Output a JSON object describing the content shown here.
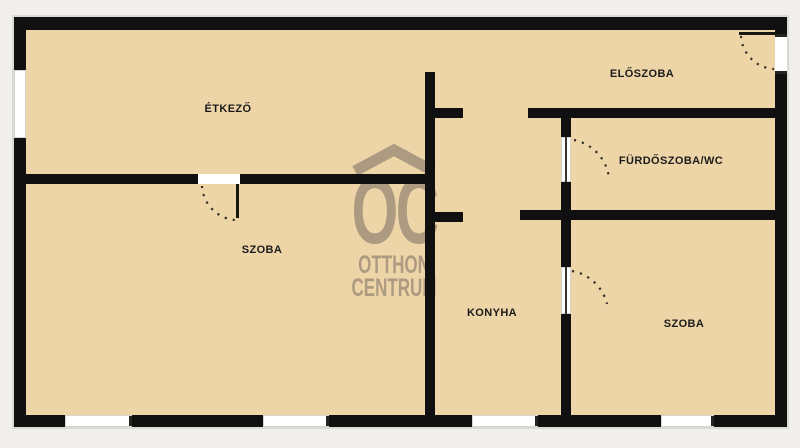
{
  "colors": {
    "background": "#f0efec",
    "floor": "#eed5a8",
    "wall": "#101010",
    "window": "#ffffff",
    "label_text": "#1b1b1b",
    "watermark": "#a3937c"
  },
  "watermark": {
    "logo": "OC",
    "line1": "OTTHON",
    "line2": "CENTRUM"
  },
  "rooms": [
    {
      "id": "etkezo",
      "label": "ÉTKEZŐ",
      "cx": 228,
      "cy": 109
    },
    {
      "id": "eloszoba",
      "label": "ELŐSZOBA",
      "cx": 642,
      "cy": 74
    },
    {
      "id": "furdoszoba-wc",
      "label": "FÜRDŐSZOBA/WC",
      "cx": 671,
      "cy": 161
    },
    {
      "id": "szoba-1",
      "label": "SZOBA",
      "cx": 262,
      "cy": 250
    },
    {
      "id": "konyha",
      "label": "KONYHA",
      "cx": 492,
      "cy": 313
    },
    {
      "id": "szoba-2",
      "label": "SZOBA",
      "cx": 684,
      "cy": 324
    }
  ],
  "geometry": {
    "plan": {
      "x": 14,
      "y": 17,
      "w": 773,
      "h": 410
    },
    "walls": [
      {
        "name": "outer-wall-top",
        "x": 14,
        "y": 17,
        "w": 773,
        "h": 13
      },
      {
        "name": "outer-wall-left",
        "x": 14,
        "y": 17,
        "w": 12,
        "h": 410
      },
      {
        "name": "outer-wall-right",
        "x": 775,
        "y": 17,
        "w": 12,
        "h": 410
      },
      {
        "name": "outer-wall-bottom",
        "x": 14,
        "y": 415,
        "w": 773,
        "h": 12
      },
      {
        "name": "wall-etkezo-szoba-divider",
        "x": 26,
        "y": 174,
        "w": 404,
        "h": 10
      },
      {
        "name": "wall-central-vertical",
        "x": 425,
        "y": 72,
        "w": 10,
        "h": 345
      },
      {
        "name": "wall-stub-upper",
        "x": 430,
        "y": 108,
        "w": 33,
        "h": 10
      },
      {
        "name": "wall-stub-lower",
        "x": 430,
        "y": 212,
        "w": 33,
        "h": 10
      },
      {
        "name": "wall-eloszoba-furdo-divider",
        "x": 528,
        "y": 108,
        "w": 247,
        "h": 10
      },
      {
        "name": "wall-right-vertical",
        "x": 561,
        "y": 110,
        "w": 10,
        "h": 307
      },
      {
        "name": "wall-furdo-bottom",
        "x": 520,
        "y": 210,
        "w": 255,
        "h": 10
      }
    ],
    "windows": [
      {
        "name": "window-left",
        "x": 14,
        "y": 70,
        "w": 12,
        "h": 68,
        "orient": "v"
      },
      {
        "name": "window-bottom-1",
        "x": 65,
        "y": 415,
        "w": 67,
        "h": 12,
        "orient": "h"
      },
      {
        "name": "window-bottom-2",
        "x": 263,
        "y": 415,
        "w": 66,
        "h": 12,
        "orient": "h"
      },
      {
        "name": "window-bottom-3",
        "x": 472,
        "y": 415,
        "w": 66,
        "h": 12,
        "orient": "h"
      },
      {
        "name": "window-bottom-4",
        "x": 661,
        "y": 415,
        "w": 53,
        "h": 12,
        "orient": "h"
      }
    ],
    "openings": [
      {
        "name": "entrance-door-opening",
        "x": 775,
        "y": 34,
        "w": 12,
        "h": 40,
        "ticks": "v"
      },
      {
        "name": "szoba-door-opening",
        "x": 198,
        "y": 174,
        "w": 42,
        "h": 10,
        "ticks": ""
      }
    ],
    "panel_doors": [
      {
        "name": "bathroom-door",
        "x": 561,
        "y": 137,
        "w": 10,
        "h": 45
      },
      {
        "name": "konyha-szoba-door",
        "x": 561,
        "y": 267,
        "w": 10,
        "h": 47
      }
    ],
    "leaves": [
      {
        "name": "entrance-door-leaf",
        "x": 739,
        "y": 32,
        "w": 38,
        "h": 3
      },
      {
        "name": "szoba-door-leaf",
        "x": 236,
        "y": 184,
        "w": 3,
        "h": 34
      }
    ],
    "arcs": [
      {
        "name": "entrance-door-arc",
        "d": "M 741 36 A 35 35 0 0 0 774 69"
      },
      {
        "name": "szoba-door-arc",
        "d": "M 202 186 A 36 36 0 0 0 236 220"
      },
      {
        "name": "bathroom-door-arc",
        "d": "M 574 140 A 44 44 0 0 1 609 178"
      },
      {
        "name": "konyha-door-arc",
        "d": "M 572 271 A 44 44 0 0 1 607 304"
      }
    ]
  }
}
